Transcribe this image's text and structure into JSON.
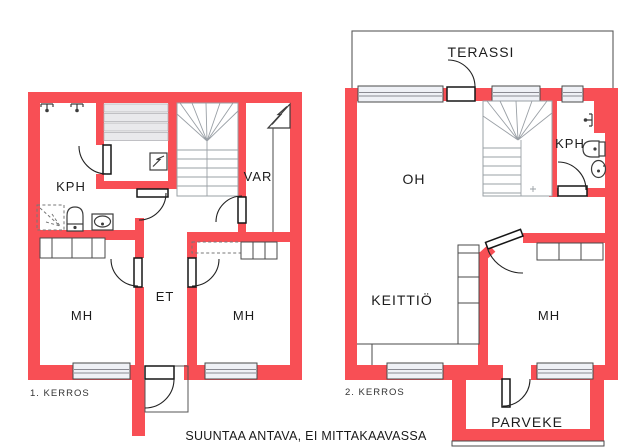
{
  "title": "Floor plan drawing",
  "colors": {
    "wall": "#F84F55",
    "window_fill": "#EFF1F6",
    "bench": "#E9E9EC",
    "outline": "#3C3C3C",
    "stair": "#9AA0A6"
  },
  "floor1": {
    "caption": "1. KERROS",
    "rooms": {
      "kph": "KPH",
      "var": "VAR",
      "et": "ET",
      "mh_left": "MH",
      "mh_right": "MH"
    }
  },
  "floor2": {
    "caption": "2. KERROS",
    "rooms": {
      "terassi": "TERASSI",
      "oh": "OH",
      "kph": "KPH",
      "keittio": "KEITTIÖ",
      "mh": "MH",
      "parveke": "PARVEKE"
    }
  },
  "footer": "SUUNTAA ANTAVA, EI MITTAKAAVASSA",
  "icons": {
    "shower": "shower-head-icon",
    "sauna_stove": "sauna-stove-icon",
    "electrical_panel": "electrical-panel-icon",
    "toilet": "toilet-icon",
    "sink": "sink-icon"
  }
}
